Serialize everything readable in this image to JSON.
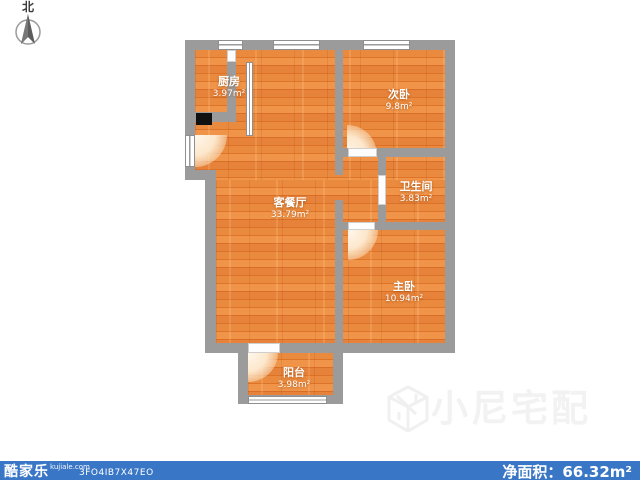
{
  "compass": {
    "label": "北"
  },
  "rooms": [
    {
      "id": "kitchen",
      "name": "厨房",
      "area": "3.97m²"
    },
    {
      "id": "bedroom2",
      "name": "次卧",
      "area": "9.8m²"
    },
    {
      "id": "living",
      "name": "客餐厅",
      "area": "33.79m²"
    },
    {
      "id": "bathroom",
      "name": "卫生间",
      "area": "3.83m²"
    },
    {
      "id": "master",
      "name": "主卧",
      "area": "10.94m²"
    },
    {
      "id": "balcony",
      "name": "阳台",
      "area": "3.98m²"
    }
  ],
  "watermark": {
    "text": "小尼宅配"
  },
  "footer": {
    "brand": "酷家乐",
    "site": "kujiale.com",
    "code": "3FO4IB7X47EO",
    "net_area_label": "净面积：",
    "net_area_value": "66.32",
    "net_area_unit": "m²",
    "bar_color": "#3a76c6"
  },
  "colors": {
    "wall": "#9b9b9b",
    "floor": "#e8873c",
    "footer_bar": "#3a76c6",
    "watermark": "#f2f2f2"
  }
}
